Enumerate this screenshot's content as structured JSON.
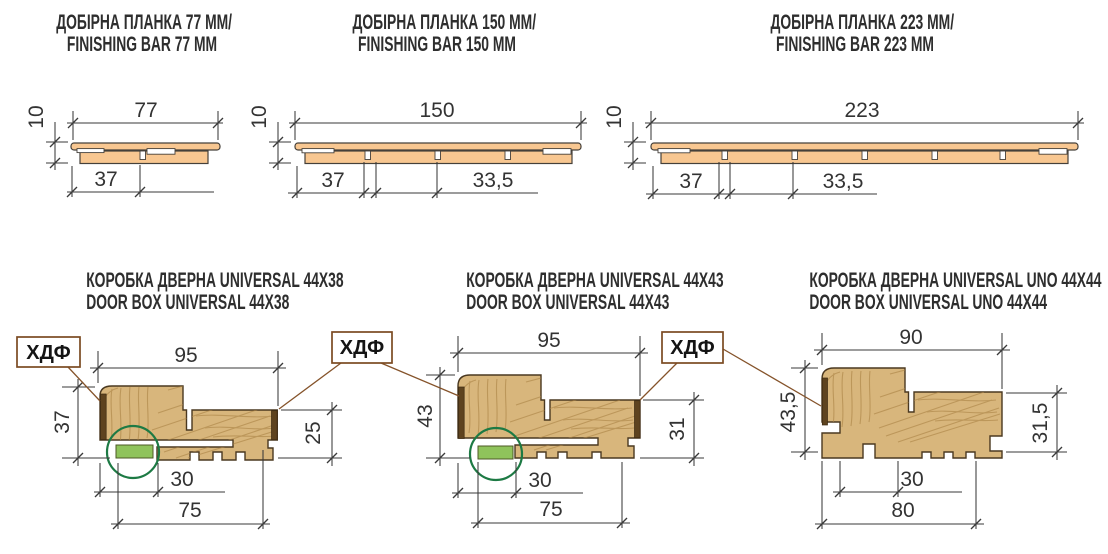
{
  "colors": {
    "background": "#ffffff",
    "wood_fill": "#d8b67c",
    "wood_grain": "#aa8245",
    "bar_fill": "#f8c791",
    "hdf_strip": "#5e431f",
    "seal_green": "#8fc35b",
    "circle_green": "#1d7a44",
    "leader_brown": "#85532a",
    "label_border": "#7b4a22",
    "dim_line": "#3a3a3a",
    "title_text": "#2e2e2e"
  },
  "finishing_bars": [
    {
      "title_uk": "ДОБІРНА ПЛАНКА 77 ММ/",
      "title_en": "FINISHING BAR 77 MM",
      "dim_width": "77",
      "dim_thickness": "10",
      "dim_groove_offset": "37"
    },
    {
      "title_uk": "ДОБІРНА ПЛАНКА 150 ММ/",
      "title_en": "FINISHING BAR 150 MM",
      "dim_width": "150",
      "dim_thickness": "10",
      "dim_groove_offset": "37",
      "dim_groove_spacing": "33,5"
    },
    {
      "title_uk": "ДОБІРНА ПЛАНКА 223 ММ/",
      "title_en": "FINISHING BAR 223 MM",
      "dim_width": "223",
      "dim_thickness": "10",
      "dim_groove_offset": "37",
      "dim_groove_spacing": "33,5"
    }
  ],
  "door_boxes": [
    {
      "title_uk": "КОРОБКА ДВЕРНА UNIVERSAL 44Х38",
      "title_en": "DOOR BOX UNIVERSAL 44X38",
      "dim_top_width": "95",
      "dim_left_height": "37",
      "dim_right_height": "25",
      "dim_seal_offset": "30",
      "dim_bottom_width": "75"
    },
    {
      "title_uk": "КОРОБКА ДВЕРНА UNIVERSAL 44Х43",
      "title_en": "DOOR BOX UNIVERSAL 44X43",
      "dim_top_width": "95",
      "dim_left_height": "43",
      "dim_right_height": "31",
      "dim_seal_offset": "30",
      "dim_bottom_width": "75"
    },
    {
      "title_uk": "КОРОБКА ДВЕРНА UNIVERSAL UNO 44Х44",
      "title_en": "DOOR BOX UNIVERSAL UNO 44X44",
      "dim_top_width": "90",
      "dim_left_height": "43,5",
      "dim_right_height": "31,5",
      "dim_seal_offset": "30",
      "dim_bottom_width": "80"
    }
  ],
  "hdf_labels": [
    "ХДФ",
    "ХДФ",
    "ХДФ"
  ]
}
